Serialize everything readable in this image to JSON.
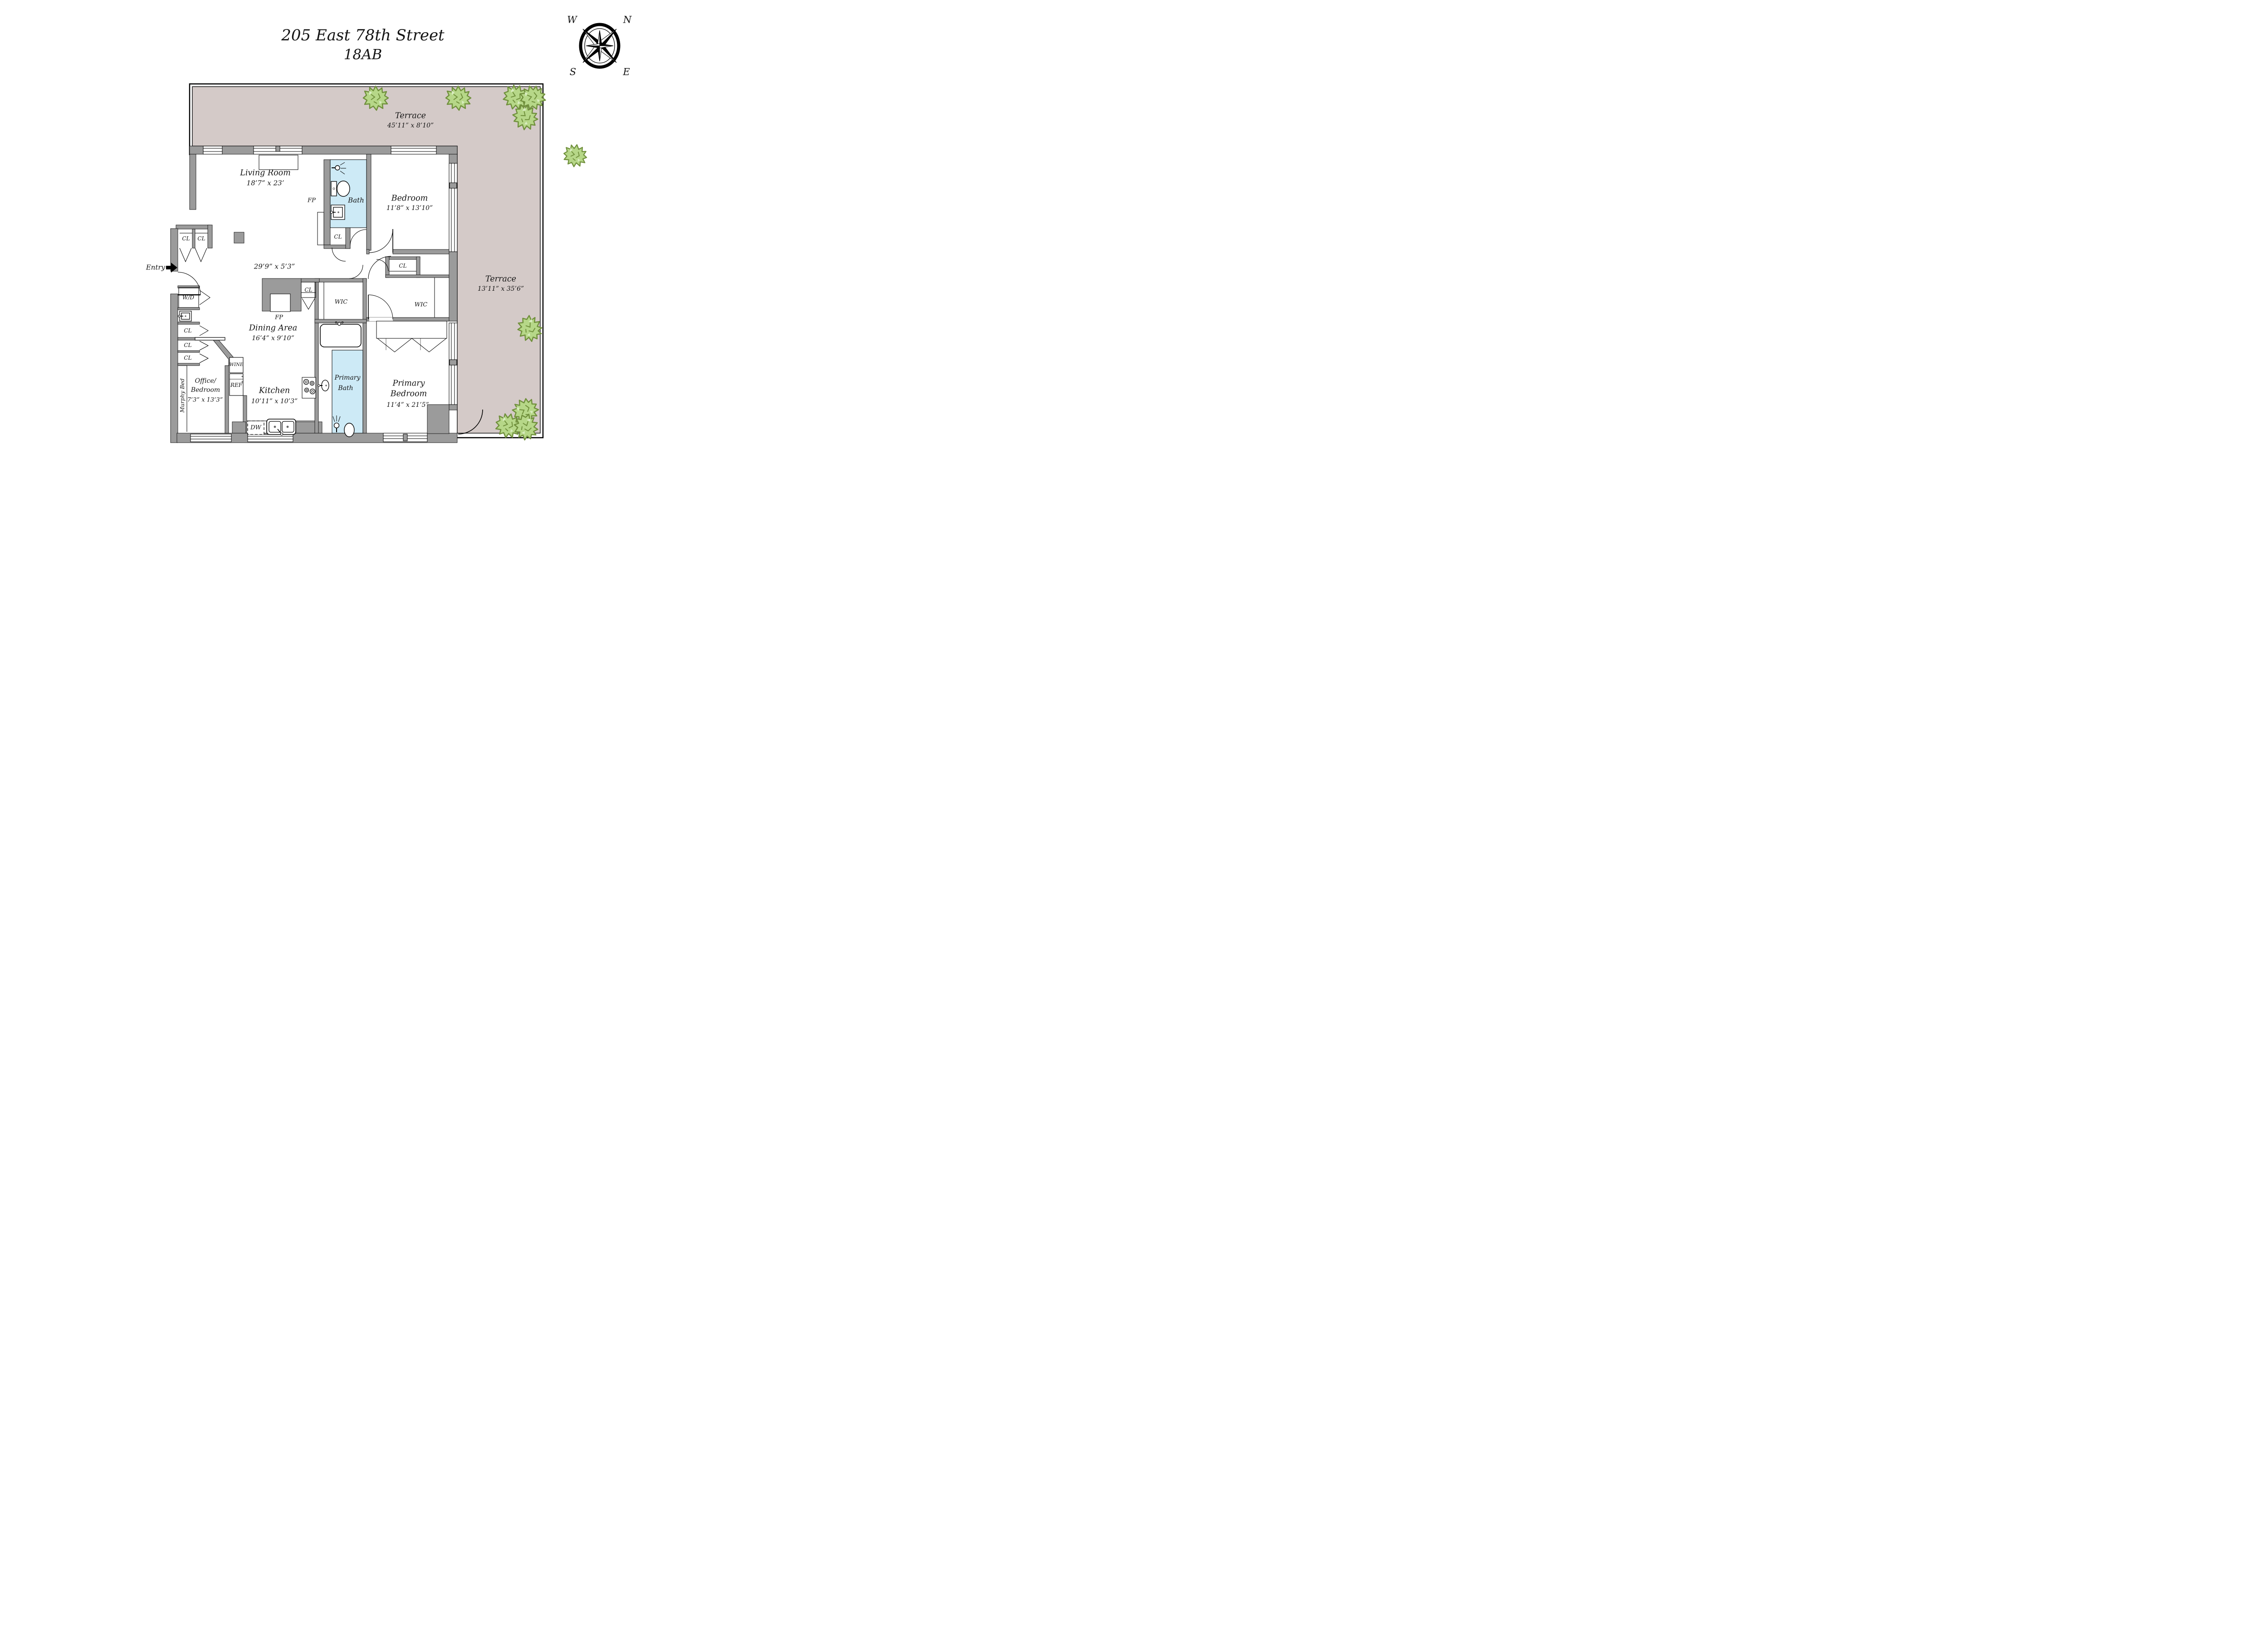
{
  "title": {
    "line1": "205 East 78th Street",
    "line2": "18AB"
  },
  "compass": {
    "n": "N",
    "s": "S",
    "e": "E",
    "w": "W"
  },
  "colors": {
    "wall": "#9b9b9b",
    "terrace_fill": "#d4cac8",
    "bath_fill": "#cdeaf6",
    "tree_fill": "#b6d788",
    "tree_stroke": "#70903c",
    "line": "#000000"
  },
  "rooms": {
    "terrace_top": {
      "name": "Terrace",
      "dims": "45’11” x 8’10”"
    },
    "terrace_right": {
      "name": "Terrace",
      "dims": "13’11” x 35’6”"
    },
    "living_room": {
      "name": "Living Room",
      "dims": "18’7” x 23’"
    },
    "bath": {
      "name": "Bath"
    },
    "bedroom": {
      "name": "Bedroom",
      "dims": "11’8” x 13’10”"
    },
    "gallery": {
      "dims": "29’9” x 5’3”"
    },
    "dining": {
      "name": "Dining Area",
      "dims": "16’4” x 9’10”"
    },
    "kitchen": {
      "name": "Kitchen",
      "dims": "10’11” x 10’3”"
    },
    "office": {
      "name_line1": "Office/",
      "name_line2": "Bedroom",
      "dims": "7’3” x 13’3”"
    },
    "primary_bedroom": {
      "name_line1": "Primary",
      "name_line2": "Bedroom",
      "dims": "11’4” x 21’5”"
    },
    "primary_bath": {
      "name_line1": "Primary",
      "name_line2": "Bath"
    }
  },
  "labels": {
    "entry": "Entry",
    "fp": "FP",
    "cl": "CL",
    "wic": "WIC",
    "wd": "W/D",
    "dw": "DW",
    "ref": "REF",
    "wine": "WINE",
    "murphy_bed": "Murphy Bed"
  }
}
